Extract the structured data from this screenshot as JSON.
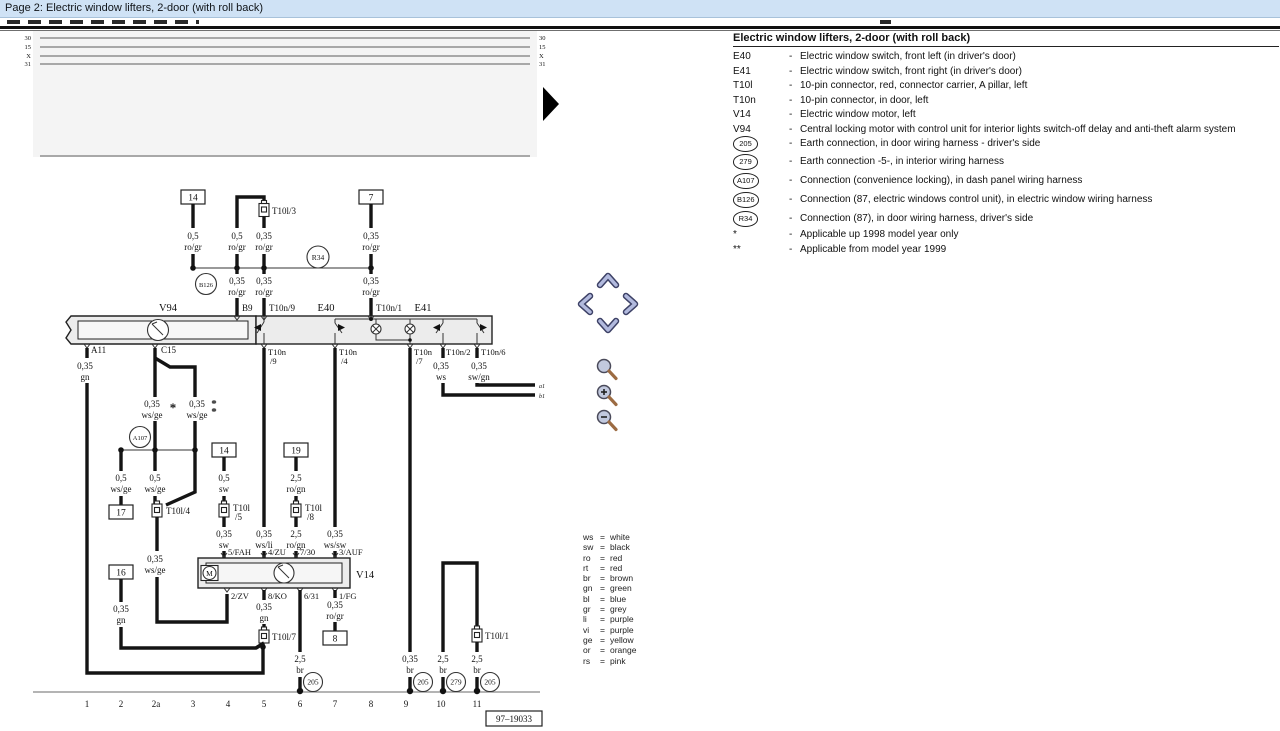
{
  "window": {
    "title": "Page 2: Electric window lifters, 2-door (with roll back)"
  },
  "legend": {
    "title": "Electric window lifters, 2-door (with roll back)",
    "dash": "-",
    "items": [
      {
        "code": "E40",
        "desc": "Electric window switch, front left (in driver's door)"
      },
      {
        "code": "E41",
        "desc": "Electric window switch, front right (in driver's door)"
      },
      {
        "code": "T10l",
        "desc": "10-pin connector, red, connector carrier, A pillar, left"
      },
      {
        "code": "T10n",
        "desc": "10-pin connector, in door, left"
      },
      {
        "code": "V14",
        "desc": "Electric window motor, left"
      },
      {
        "code": "V94",
        "desc": "Central locking motor with control unit for interior lights switch-off delay and anti-theft alarm system"
      },
      {
        "code": "205",
        "desc": "Earth connection, in door wiring harness - driver's side"
      },
      {
        "code": "279",
        "desc": "Earth connection -5-, in interior wiring harness"
      },
      {
        "code": "A107",
        "desc": "Connection (convenience locking), in dash panel wiring harness"
      },
      {
        "code": "B126",
        "desc": "Connection (87, electric windows control unit), in electric window wiring harness"
      },
      {
        "code": "R34",
        "desc": "Connection (87), in door wiring harness, driver's side"
      },
      {
        "code": "*",
        "desc": "Applicable up 1998 model year only"
      },
      {
        "code": "**",
        "desc": "Applicable from model year 1999"
      }
    ]
  },
  "color_key": {
    "eq": "=",
    "items": [
      {
        "abbr": "ws",
        "name": "white"
      },
      {
        "abbr": "sw",
        "name": "black"
      },
      {
        "abbr": "ro",
        "name": "red"
      },
      {
        "abbr": "rt",
        "name": "red"
      },
      {
        "abbr": "br",
        "name": "brown"
      },
      {
        "abbr": "gn",
        "name": "green"
      },
      {
        "abbr": "bl",
        "name": "blue"
      },
      {
        "abbr": "gr",
        "name": "grey"
      },
      {
        "abbr": "li",
        "name": "purple"
      },
      {
        "abbr": "vi",
        "name": "purple"
      },
      {
        "abbr": "ge",
        "name": "yellow"
      },
      {
        "abbr": "or",
        "name": "orange"
      },
      {
        "abbr": "rs",
        "name": "pink"
      }
    ]
  },
  "schematic": {
    "bus": [
      "30",
      "15",
      "X",
      "31"
    ],
    "boxes": {
      "b14a": "14",
      "b7": "7",
      "b14b": "14",
      "b19": "19",
      "b17": "17",
      "b16": "16",
      "b8": "8"
    },
    "circles": {
      "r34": "R34",
      "b126": "B126",
      "a107": "A107"
    },
    "grounds": {
      "g6": "205",
      "g9": "205",
      "g10": "279",
      "g11": "205"
    },
    "connectors": {
      "t10l3": "T10l/3",
      "t10l4": "T10l/4",
      "t10l5a": "T10l",
      "t10l5b": "/5",
      "t10l8a": "T10l",
      "t10l8b": "/8",
      "t10l7": "T10l/7",
      "t10l1": "T10l/1"
    },
    "components": {
      "v94": "V94",
      "e40": "E40",
      "e41": "E41",
      "v14": "V14"
    },
    "terminals": {
      "b9": "B9",
      "t10n9": "T10n/9",
      "t10n1": "T10n/1",
      "a11": "A11",
      "c15": "C15",
      "bl1": "T10n",
      "bl2": "/9",
      "bm1": "T10n",
      "bm2": "/4",
      "bn1": "T10n",
      "bn2": "/7",
      "t10n2": "T10n/2",
      "t10n6": "T10n/6",
      "fah": "5/FAH",
      "zu": "4/ZU",
      "p730": "7/30",
      "auf": "3/AUF",
      "zv": "2/ZV",
      "ko": "8/KO",
      "p631": "6/31",
      "fg": "1/FG",
      "a1": "a1",
      "b1": "b1",
      "m": "M"
    },
    "marks": {
      "star": "*"
    },
    "wires": {
      "w_193": [
        "0,5",
        "ro/gr"
      ],
      "w_237_top": [
        "0,5",
        "ro/gr"
      ],
      "w_265_top": [
        "0,35",
        "ro/gr"
      ],
      "w_371_top": [
        "0,35",
        "ro/gr"
      ],
      "w_237_mid": [
        "0,35",
        "ro/gr"
      ],
      "w_265_mid": [
        "0,35",
        "ro/gr"
      ],
      "w_371_mid": [
        "0,35",
        "ro/gr"
      ],
      "w_a11": [
        "0,35",
        "gn"
      ],
      "w_c15_l": [
        "0,35",
        "ws/ge"
      ],
      "w_c15_r": [
        "0,35",
        "ws/ge"
      ],
      "w_box17": [
        "0,5",
        "ws/ge"
      ],
      "w_t10l4": [
        "0,5",
        "ws/ge"
      ],
      "w_t10l4b": [
        "0,35",
        "ws/ge"
      ],
      "w_box14b": [
        "0,5",
        "sw"
      ],
      "w_t10l5b": [
        "0,35",
        "sw"
      ],
      "w_box19": [
        "2,5",
        "ro/gn"
      ],
      "w_t10l8b": [
        "2,5",
        "ro/gn"
      ],
      "w_zu": [
        "0,35",
        "ws/li"
      ],
      "w_auf": [
        "0,35",
        "ws/sw"
      ],
      "w_t10n2": [
        "0,35",
        "ws"
      ],
      "w_t10n6": [
        "0,35",
        "sw/gn"
      ],
      "w_box16": [
        "0,35",
        "gn"
      ],
      "w_ko": [
        "0,35",
        "gn"
      ],
      "w_fg": [
        "0,35",
        "ro/gr"
      ],
      "w_g6": [
        "2,5",
        "br"
      ],
      "w_g9": [
        "0,35",
        "br"
      ],
      "w_g10": [
        "2,5",
        "br"
      ],
      "w_g11": [
        "2,5",
        "br"
      ]
    },
    "tracks": [
      "1",
      "2",
      "2a",
      "3",
      "4",
      "5",
      "6",
      "7",
      "8",
      "9",
      "10",
      "11"
    ],
    "ref": "97–19033"
  }
}
